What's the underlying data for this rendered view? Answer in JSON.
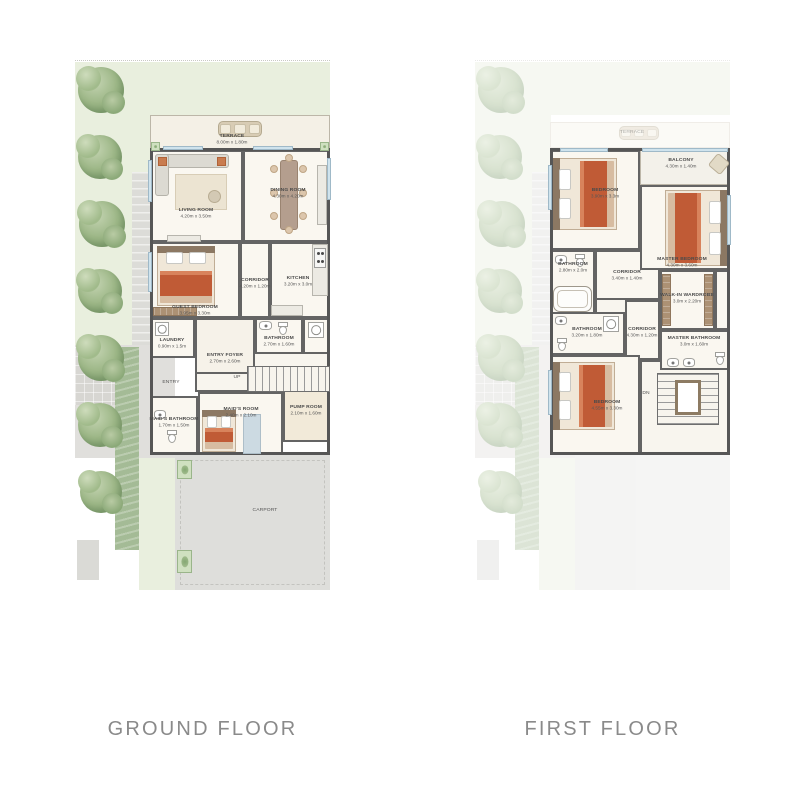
{
  "page": {
    "bg": "#ffffff"
  },
  "floors": [
    {
      "id": "ground-floor-plan",
      "caption": "GROUND FLOOR",
      "panel": {
        "x": 75,
        "y": 60,
        "w": 255,
        "h": 530
      },
      "landscape_opacity": 1,
      "building": {
        "x": 75,
        "y": 88,
        "w": 180,
        "h": 307
      },
      "landscape": [
        {
          "t": "rect",
          "name": "plot-boundary",
          "x": 0,
          "y": 0,
          "w": 255,
          "h": 2,
          "cls": "dotted-top"
        },
        {
          "t": "rect",
          "name": "grass-top",
          "x": 0,
          "y": 2,
          "w": 255,
          "h": 53,
          "fill": "#e9efde"
        },
        {
          "t": "rect",
          "name": "grass-left",
          "x": 0,
          "y": 2,
          "w": 76,
          "h": 283,
          "fill": "#e9efde"
        },
        {
          "t": "rect",
          "name": "stone-path",
          "x": 57,
          "y": 112,
          "w": 19,
          "h": 173,
          "fill": "#dcdcd8",
          "cls": "stripe-h"
        },
        {
          "t": "rect",
          "name": "entry-walk",
          "x": 0,
          "y": 285,
          "w": 100,
          "h": 113,
          "fill": "#e0dfdc"
        },
        {
          "t": "rect",
          "name": "paver-pad",
          "x": 0,
          "y": 287,
          "w": 44,
          "h": 58,
          "fill": "#d7d6d2",
          "cls": "stripe-grid"
        },
        {
          "t": "rect",
          "name": "hedge",
          "x": 40,
          "y": 287,
          "w": 24,
          "h": 203,
          "fill": "#a4bb96",
          "cls": "stripe-hedge"
        },
        {
          "t": "rect",
          "name": "side-grass",
          "x": 64,
          "y": 398,
          "w": 36,
          "h": 132,
          "fill": "#e9efde"
        },
        {
          "t": "rect",
          "name": "carport-paving",
          "x": 100,
          "y": 395,
          "w": 155,
          "h": 135,
          "fill": "#dededb",
          "cls": "dash"
        },
        {
          "t": "rect",
          "name": "utility-pad",
          "x": 2,
          "y": 480,
          "w": 22,
          "h": 40,
          "fill": "#dadad6"
        },
        {
          "t": "planter",
          "x": 102,
          "y": 400,
          "w": 15,
          "h": 19
        },
        {
          "t": "planter",
          "x": 102,
          "y": 490,
          "w": 15,
          "h": 23
        },
        {
          "t": "tree",
          "cx": 26,
          "cy": 30,
          "r": 23
        },
        {
          "t": "tree",
          "cx": 25,
          "cy": 97,
          "r": 22
        },
        {
          "t": "tree",
          "cx": 27,
          "cy": 164,
          "r": 23
        },
        {
          "t": "tree",
          "cx": 25,
          "cy": 231,
          "r": 22
        },
        {
          "t": "tree",
          "cx": 26,
          "cy": 298,
          "r": 23
        },
        {
          "t": "tree",
          "cx": 25,
          "cy": 365,
          "r": 22
        },
        {
          "t": "tree",
          "cx": 26,
          "cy": 432,
          "r": 21
        }
      ],
      "rooms": [
        {
          "name": "terrace",
          "label": "TERRACE",
          "dims": "8.00m x 1.80m",
          "x": 75,
          "y": 55,
          "w": 180,
          "h": 35,
          "fill": "#f4f0e6",
          "light": true,
          "lx": 157,
          "ly": 79
        },
        {
          "name": "hall",
          "x": 120,
          "y": 258,
          "w": 135,
          "h": 74,
          "fill": "#f8f5ee"
        },
        {
          "name": "laundry",
          "label": "LAUNDRY",
          "dims": "0.90m x 1.5m",
          "x": 75,
          "y": 258,
          "w": 45,
          "h": 40,
          "lx": 97,
          "ly": 283
        },
        {
          "name": "entry-foyer",
          "label": "ENTRY FOYER",
          "dims": "2.70m x 2.60m",
          "x": 120,
          "y": 258,
          "w": 60,
          "h": 56,
          "fill": "#f6f2e9",
          "lx": 150,
          "ly": 298
        },
        {
          "name": "bathroom",
          "label": "BATHROOM",
          "dims": "2.70m x 1.60m",
          "x": 180,
          "y": 258,
          "w": 48,
          "h": 36,
          "lx": 204,
          "ly": 281
        },
        {
          "name": "powder",
          "x": 228,
          "y": 258,
          "w": 27,
          "h": 36
        },
        {
          "name": "maids-bathroom",
          "label": "MAID'S BATHROOM",
          "dims": "1.70m x 1.50m",
          "x": 75,
          "y": 336,
          "w": 48,
          "h": 59,
          "lx": 99,
          "ly": 362
        },
        {
          "name": "maids-room",
          "label": "MAID'S ROOM",
          "dims": "2.40m x 2.10m",
          "x": 123,
          "y": 332,
          "w": 85,
          "h": 63,
          "lx": 166,
          "ly": 352
        },
        {
          "name": "pump-room",
          "label": "PUMP ROOM",
          "dims": "2.10m x 1.60m",
          "x": 208,
          "y": 330,
          "w": 47,
          "h": 52,
          "fill": "#f2ead9",
          "lx": 231,
          "ly": 350
        },
        {
          "name": "living-room",
          "label": "LIVING ROOM",
          "dims": "4.20m x 3.50m",
          "x": 75,
          "y": 90,
          "w": 93,
          "h": 92,
          "lx": 121,
          "ly": 153
        },
        {
          "name": "dining-room",
          "label": "DINING ROOM",
          "dims": "4.30m x 4.20m",
          "x": 168,
          "y": 90,
          "w": 87,
          "h": 92,
          "lx": 213,
          "ly": 133
        },
        {
          "name": "guest-bedroom",
          "label": "GUEST BEDROOM",
          "dims": "3.95m x 3.30m",
          "x": 75,
          "y": 182,
          "w": 90,
          "h": 76,
          "lx": 120,
          "ly": 250
        },
        {
          "name": "corridor",
          "label": "CORRIDOR",
          "dims": "4.20m x 1.20m",
          "x": 165,
          "y": 182,
          "w": 30,
          "h": 76,
          "lx": 180,
          "ly": 223
        },
        {
          "name": "kitchen",
          "label": "KITCHEN",
          "dims": "3.20m x 3.0m",
          "x": 195,
          "y": 182,
          "w": 60,
          "h": 76,
          "lx": 223,
          "ly": 221
        }
      ],
      "windows": [
        {
          "x": 88,
          "y": 86,
          "w": 40,
          "h": 4
        },
        {
          "x": 178,
          "y": 86,
          "w": 40,
          "h": 4
        },
        {
          "x": 73,
          "y": 100,
          "w": 4,
          "h": 42
        },
        {
          "x": 73,
          "y": 192,
          "w": 4,
          "h": 40
        },
        {
          "x": 252,
          "y": 98,
          "w": 4,
          "h": 42
        }
      ],
      "furniture": [
        {
          "t": "bench",
          "x": 143,
          "y": 61,
          "w": 44,
          "h": 16
        },
        {
          "t": "planter",
          "x": 76,
          "y": 82,
          "w": 9,
          "h": 9
        },
        {
          "t": "planter",
          "x": 245,
          "y": 82,
          "w": 9,
          "h": 9
        },
        {
          "t": "sofa",
          "x": 80,
          "y": 94,
          "w": 74,
          "h": 58
        },
        {
          "t": "counter",
          "x": 92,
          "y": 175,
          "w": 34,
          "h": 7
        },
        {
          "t": "dining",
          "x": 194,
          "y": 96,
          "w": 40,
          "h": 78
        },
        {
          "t": "counter",
          "x": 242,
          "y": 105,
          "w": 10,
          "h": 60
        },
        {
          "t": "counter",
          "x": 237,
          "y": 184,
          "w": 16,
          "h": 52
        },
        {
          "t": "stove",
          "x": 239,
          "y": 188,
          "w": 12,
          "h": 20
        },
        {
          "t": "counter",
          "x": 196,
          "y": 245,
          "w": 32,
          "h": 11
        },
        {
          "t": "bed",
          "head": "n",
          "x": 82,
          "y": 186,
          "w": 58,
          "h": 60
        },
        {
          "t": "wardrobe",
          "x": 78,
          "y": 247,
          "w": 44,
          "h": 9
        },
        {
          "t": "machine",
          "x": 80,
          "y": 262,
          "w": 14,
          "h": 14
        },
        {
          "t": "sink",
          "x": 184,
          "y": 261,
          "w": 13,
          "h": 9
        },
        {
          "t": "wc",
          "x": 203,
          "y": 262,
          "w": 10,
          "h": 13
        },
        {
          "t": "shower",
          "x": 233,
          "y": 262,
          "w": 16,
          "h": 16
        },
        {
          "t": "bed",
          "head": "n",
          "x": 127,
          "y": 350,
          "w": 34,
          "h": 42
        },
        {
          "t": "mat",
          "x": 168,
          "y": 354,
          "w": 16,
          "h": 38
        },
        {
          "t": "sink",
          "x": 79,
          "y": 350,
          "w": 12,
          "h": 9
        },
        {
          "t": "wc",
          "x": 92,
          "y": 370,
          "w": 10,
          "h": 13
        },
        {
          "t": "stairs",
          "dir": "h",
          "x": 172,
          "y": 306,
          "w": 83,
          "h": 26
        }
      ],
      "labels": [
        {
          "text": "ENTRY",
          "x": 96,
          "y": 322
        },
        {
          "text": "UP",
          "x": 162,
          "y": 317
        },
        {
          "text": "CARPORT",
          "x": 190,
          "y": 450
        }
      ]
    },
    {
      "id": "first-floor-plan",
      "caption": "FIRST FLOOR",
      "panel": {
        "x": 475,
        "y": 60,
        "w": 255,
        "h": 530
      },
      "landscape_opacity": 0.38,
      "building": {
        "x": 75,
        "y": 88,
        "w": 180,
        "h": 307
      },
      "landscape": [
        {
          "t": "rect",
          "name": "plot-boundary",
          "x": 0,
          "y": 0,
          "w": 255,
          "h": 2,
          "cls": "dotted-top"
        },
        {
          "t": "rect",
          "name": "grass-top",
          "x": 0,
          "y": 2,
          "w": 255,
          "h": 53,
          "fill": "#e9efde"
        },
        {
          "t": "rect",
          "name": "grass-left",
          "x": 0,
          "y": 2,
          "w": 76,
          "h": 283,
          "fill": "#e9efde"
        },
        {
          "t": "rect",
          "name": "stone-path",
          "x": 57,
          "y": 112,
          "w": 19,
          "h": 173,
          "fill": "#dcdcd8",
          "cls": "stripe-h"
        },
        {
          "t": "rect",
          "name": "entry-walk",
          "x": 0,
          "y": 285,
          "w": 100,
          "h": 113,
          "fill": "#e0dfdc"
        },
        {
          "t": "rect",
          "name": "paver-pad",
          "x": 0,
          "y": 287,
          "w": 44,
          "h": 58,
          "fill": "#d7d6d2",
          "cls": "stripe-grid"
        },
        {
          "t": "rect",
          "name": "hedge",
          "x": 40,
          "y": 287,
          "w": 24,
          "h": 203,
          "fill": "#a4bb96",
          "cls": "stripe-hedge"
        },
        {
          "t": "rect",
          "name": "side-grass",
          "x": 64,
          "y": 398,
          "w": 36,
          "h": 132,
          "fill": "#e9efde"
        },
        {
          "t": "rect",
          "name": "carport-paving",
          "x": 100,
          "y": 395,
          "w": 155,
          "h": 135,
          "fill": "#e4e4e2"
        },
        {
          "t": "rect",
          "name": "utility-pad",
          "x": 2,
          "y": 480,
          "w": 22,
          "h": 40,
          "fill": "#dadad6"
        },
        {
          "t": "rect",
          "name": "terrace-ghost",
          "x": 75,
          "y": 62,
          "w": 180,
          "h": 26,
          "fill": "#f5f2e9",
          "cls": "thin"
        },
        {
          "t": "bench",
          "x": 144,
          "y": 66,
          "w": 40,
          "h": 14
        },
        {
          "t": "tree",
          "cx": 26,
          "cy": 30,
          "r": 23
        },
        {
          "t": "tree",
          "cx": 25,
          "cy": 97,
          "r": 22
        },
        {
          "t": "tree",
          "cx": 27,
          "cy": 164,
          "r": 23
        },
        {
          "t": "tree",
          "cx": 25,
          "cy": 231,
          "r": 22
        },
        {
          "t": "tree",
          "cx": 26,
          "cy": 298,
          "r": 23
        },
        {
          "t": "tree",
          "cx": 25,
          "cy": 365,
          "r": 22
        },
        {
          "t": "tree",
          "cx": 26,
          "cy": 432,
          "r": 21
        }
      ],
      "rooms": [
        {
          "name": "hall",
          "x": 120,
          "y": 188,
          "w": 135,
          "h": 112,
          "fill": "#f8f5ee"
        },
        {
          "name": "stair-hall",
          "x": 165,
          "y": 300,
          "w": 90,
          "h": 95,
          "fill": "#f8f5ee"
        },
        {
          "name": "bathroom",
          "label": "BATHROOM",
          "dims": "2.80m x 2.0m",
          "x": 75,
          "y": 190,
          "w": 45,
          "h": 70,
          "lx": 98,
          "ly": 207
        },
        {
          "name": "corridor",
          "label": "CORRIDOR",
          "dims": "3.40m x 1.40m",
          "x": 120,
          "y": 190,
          "w": 65,
          "h": 50,
          "lx": 152,
          "ly": 215
        },
        {
          "name": "bathroom-2",
          "label": "BATHROOM",
          "dims": "3.20m x 1.80m",
          "x": 75,
          "y": 252,
          "w": 75,
          "h": 43,
          "lx": 112,
          "ly": 272
        },
        {
          "name": "corridor-2",
          "label": "CORRIDOR",
          "dims": "4.30m x 1.20m",
          "x": 150,
          "y": 240,
          "w": 35,
          "h": 60,
          "lx": 167,
          "ly": 272
        },
        {
          "name": "walk-in-wardrobe",
          "label": "WALK-IN WARDROBE",
          "dims": "3.0m x 2.20m",
          "x": 185,
          "y": 210,
          "w": 55,
          "h": 60,
          "lx": 212,
          "ly": 238
        },
        {
          "name": "closet",
          "x": 240,
          "y": 210,
          "w": 15,
          "h": 60
        },
        {
          "name": "master-bathroom",
          "label": "MASTER BATHROOM",
          "dims": "3.0m x 1.60m",
          "x": 185,
          "y": 270,
          "w": 70,
          "h": 40,
          "lx": 219,
          "ly": 281
        },
        {
          "name": "bedroom-1",
          "label": "BEDROOM",
          "dims": "3.90m x 3.3m",
          "x": 75,
          "y": 90,
          "w": 90,
          "h": 100,
          "lx": 130,
          "ly": 133
        },
        {
          "name": "balcony",
          "label": "BALCONY",
          "dims": "4.30m x 1.40m",
          "x": 165,
          "y": 90,
          "w": 90,
          "h": 35,
          "fill": "#f3f1ea",
          "light": true,
          "lx": 206,
          "ly": 103
        },
        {
          "name": "master-bedroom",
          "label": "MASTER BEDROOM",
          "dims": "4.30m x 3.60m",
          "x": 165,
          "y": 125,
          "w": 90,
          "h": 85,
          "lx": 207,
          "ly": 202
        },
        {
          "name": "bedroom-2",
          "label": "BEDROOM",
          "dims": "4.55m x 3.30m",
          "x": 75,
          "y": 295,
          "w": 90,
          "h": 100,
          "lx": 132,
          "ly": 345
        }
      ],
      "windows": [
        {
          "x": 167,
          "y": 88,
          "w": 86,
          "h": 4
        },
        {
          "x": 85,
          "y": 88,
          "w": 48,
          "h": 4
        },
        {
          "x": 73,
          "y": 105,
          "w": 4,
          "h": 45
        },
        {
          "x": 73,
          "y": 310,
          "w": 4,
          "h": 45
        },
        {
          "x": 252,
          "y": 135,
          "w": 4,
          "h": 50
        }
      ],
      "furniture": [
        {
          "t": "chair",
          "x": 236,
          "y": 96,
          "w": 14,
          "h": 14
        },
        {
          "t": "bed",
          "head": "w",
          "x": 78,
          "y": 98,
          "w": 64,
          "h": 72
        },
        {
          "t": "bed",
          "head": "e",
          "x": 190,
          "y": 130,
          "w": 62,
          "h": 76
        },
        {
          "t": "sink",
          "x": 80,
          "y": 195,
          "w": 12,
          "h": 9
        },
        {
          "t": "wc",
          "x": 100,
          "y": 194,
          "w": 10,
          "h": 13
        },
        {
          "t": "tub",
          "x": 78,
          "y": 226,
          "w": 39,
          "h": 26
        },
        {
          "t": "wardrobe",
          "x": 187,
          "y": 214,
          "w": 9,
          "h": 52
        },
        {
          "t": "wardrobe",
          "x": 229,
          "y": 214,
          "w": 9,
          "h": 52
        },
        {
          "t": "sink",
          "x": 80,
          "y": 256,
          "w": 12,
          "h": 9
        },
        {
          "t": "wc",
          "x": 82,
          "y": 278,
          "w": 10,
          "h": 13
        },
        {
          "t": "shower",
          "x": 128,
          "y": 256,
          "w": 16,
          "h": 16
        },
        {
          "t": "sink",
          "x": 192,
          "y": 298,
          "w": 12,
          "h": 9
        },
        {
          "t": "sink",
          "x": 208,
          "y": 298,
          "w": 12,
          "h": 9
        },
        {
          "t": "wc",
          "x": 240,
          "y": 292,
          "w": 10,
          "h": 13
        },
        {
          "t": "bed",
          "head": "w",
          "x": 78,
          "y": 302,
          "w": 62,
          "h": 68
        },
        {
          "t": "ustairs",
          "x": 182,
          "y": 313,
          "w": 62,
          "h": 52
        }
      ],
      "labels": [
        {
          "text": "TERRACE",
          "x": 157,
          "y": 72,
          "faint": true
        },
        {
          "text": "DN",
          "x": 171,
          "y": 333
        }
      ]
    }
  ]
}
